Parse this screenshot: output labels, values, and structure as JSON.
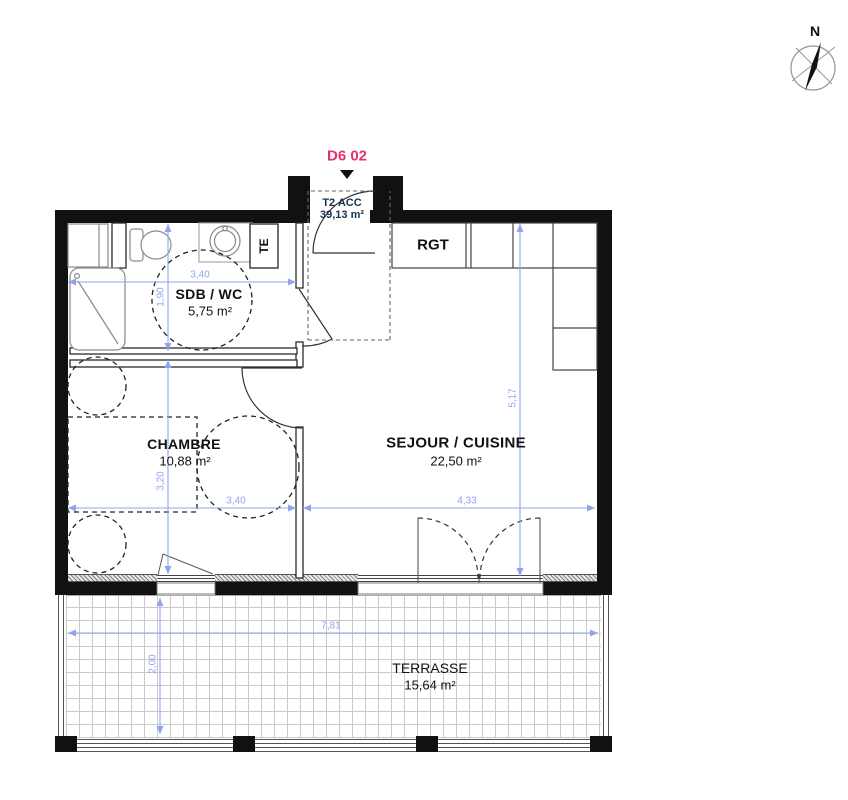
{
  "header": {
    "unit_label": "D6 02"
  },
  "compass": {
    "north_label": "N"
  },
  "unit_info": {
    "type": "T2 ACC",
    "area": "39,13 m²"
  },
  "rooms": {
    "bathroom": {
      "name": "SDB / WC",
      "area": "5,75 m²"
    },
    "bedroom": {
      "name": "CHAMBRE",
      "area": "10,88 m²"
    },
    "living": {
      "name": "SEJOUR / CUISINE",
      "area": "22,50 m²"
    },
    "terrace": {
      "name": "TERRASSE",
      "area": "15,64 m²"
    }
  },
  "closets": {
    "storage": "RGT",
    "technical": "TE"
  },
  "dimensions": {
    "bathroom_width": "3,40",
    "bathroom_depth": "1,90",
    "bedroom_depth": "3,20",
    "bedroom_width": "3,40",
    "living_width": "4,33",
    "living_depth": "5,17",
    "terrace_width": "7,81",
    "terrace_depth": "2,00"
  },
  "colors": {
    "accent_pink": "#e5326e",
    "dimension_blue": "#8ea5ee",
    "unit_navy": "#16324f",
    "wall_black": "#111111"
  }
}
